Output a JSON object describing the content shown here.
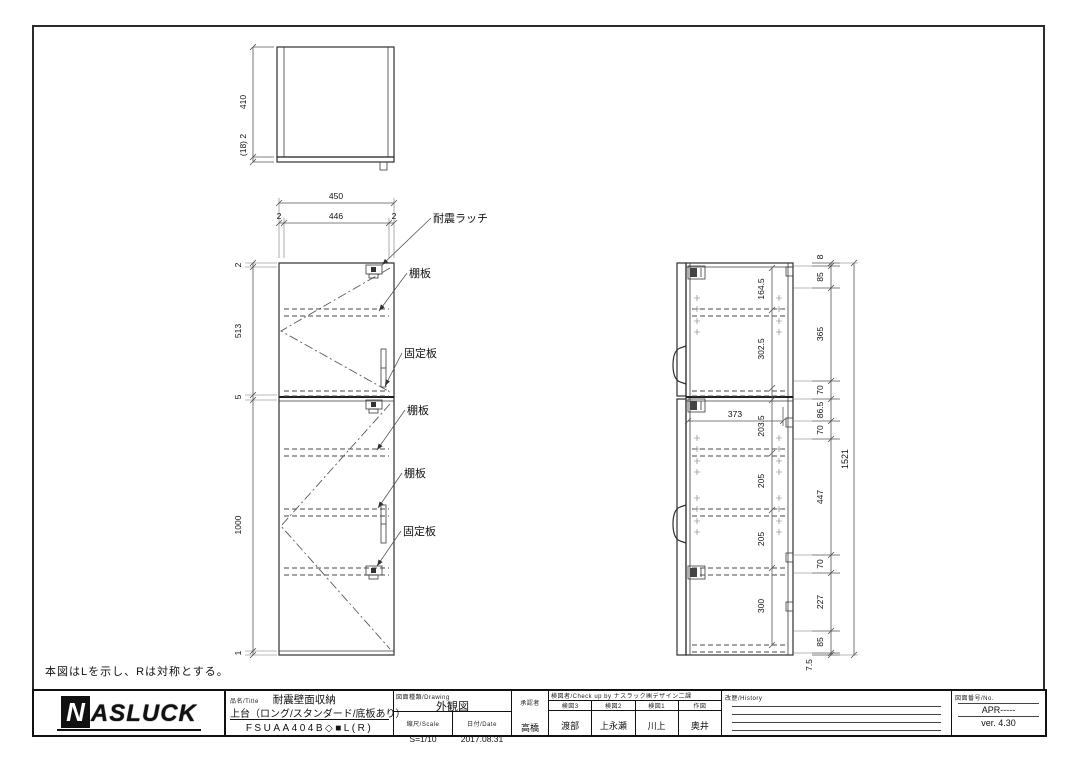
{
  "note": "本図はLを示し、Rは対称とする。",
  "top_view": {
    "height": "410",
    "base": "(18) 2"
  },
  "front_view": {
    "width_total": "450",
    "width_left": "2",
    "width_center": "446",
    "width_right": "2",
    "heights": [
      "2",
      "513",
      "5",
      "1000",
      "1"
    ],
    "leaders": [
      "耐震ラッチ",
      "棚板",
      "固定板",
      "棚板",
      "棚板",
      "固定板"
    ]
  },
  "side_view": {
    "inner": [
      "164.5",
      "302.5",
      "203.5",
      "205",
      "205",
      "300"
    ],
    "depth": "373",
    "right": [
      "8",
      "85",
      "365",
      "70",
      "86.5",
      "70",
      "447",
      "70",
      "227",
      "85",
      "7.5"
    ],
    "total": "1521"
  },
  "title_block": {
    "logo_n": "N",
    "logo_rest": "ASLUCK",
    "title_label": "品名/Title",
    "title": "耐震壁面収納",
    "subtitle": "上台（ロング/スタンダード/底板あり）",
    "model": "FSUAA404B◇■L(R)",
    "drawing_label": "図面種類/Drawing",
    "drawing_type": "外観図",
    "scale_label": "縮尺/Scale",
    "scale": "S=1/10",
    "date_label": "日付/Date",
    "date": "2017.08.31",
    "approval_label": "承認者",
    "approval": "高橋",
    "check_header": "検図者/Check up by ナスラック㈱デザイン二課",
    "checkers": [
      {
        "label": "検図3",
        "name": "渡部"
      },
      {
        "label": "検図2",
        "name": "上永瀬"
      },
      {
        "label": "検図1",
        "name": "川上"
      },
      {
        "label": "作図",
        "name": "奥井"
      }
    ],
    "history_label": "改歴/History",
    "number_label": "図面番号/No.",
    "number": "APR-----",
    "version": "ver. 4.30"
  }
}
